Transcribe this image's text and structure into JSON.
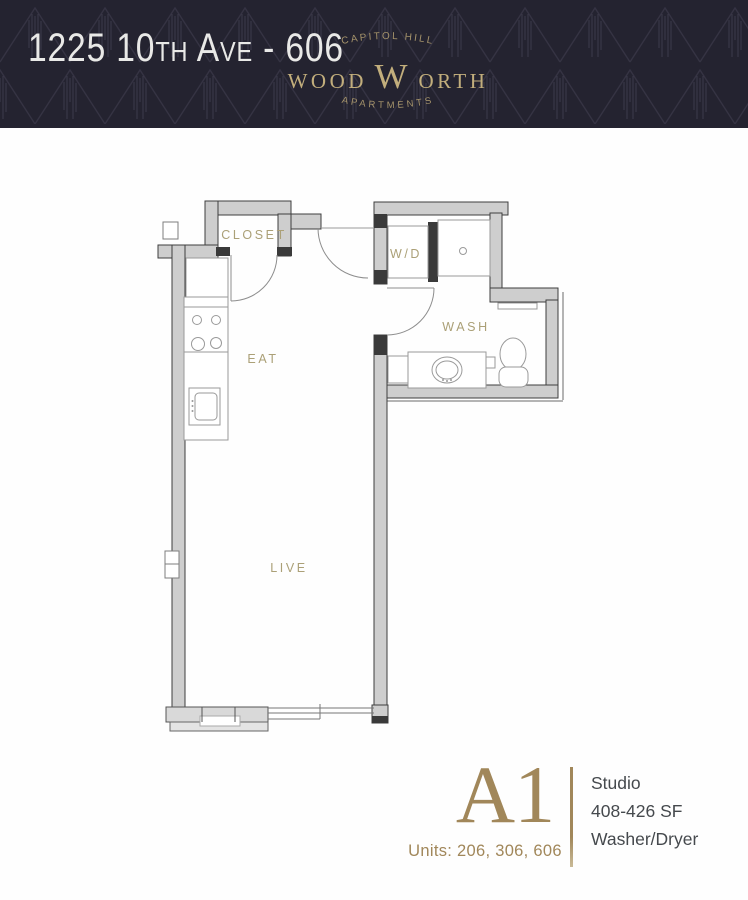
{
  "header": {
    "address": "1225 10th Ave - 606",
    "brand": {
      "top_arc": "CAPITOL HILL",
      "wordmark_pre": "WOOD",
      "wordmark_initial": "W",
      "wordmark_post": "ORTH",
      "bottom_arc": "APARTMENTS"
    },
    "colors": {
      "background": "#242330",
      "pattern_line": "#353343",
      "address_text": "#e9e9e7",
      "wordmark_gold": "#c2ae7c",
      "arc_gold": "#a5936b"
    }
  },
  "floor_plan": {
    "labels": {
      "closet": "CLOSET",
      "laundry": "W/D",
      "bath": "WASH",
      "kitchen": "EAT",
      "living": "LIVE"
    },
    "colors": {
      "label": "#aba077",
      "wall_fill": "#cecece",
      "wall_edge": "#3e3e3e",
      "fixture_line": "#9a9a9a"
    }
  },
  "unit_info": {
    "plan_code": "A1",
    "units": "Units: 206, 306, 606",
    "type": "Studio",
    "size": "408-426 SF",
    "laundry": "Washer/Dryer",
    "colors": {
      "accent": "#a1875a",
      "text": "#45494d"
    }
  }
}
